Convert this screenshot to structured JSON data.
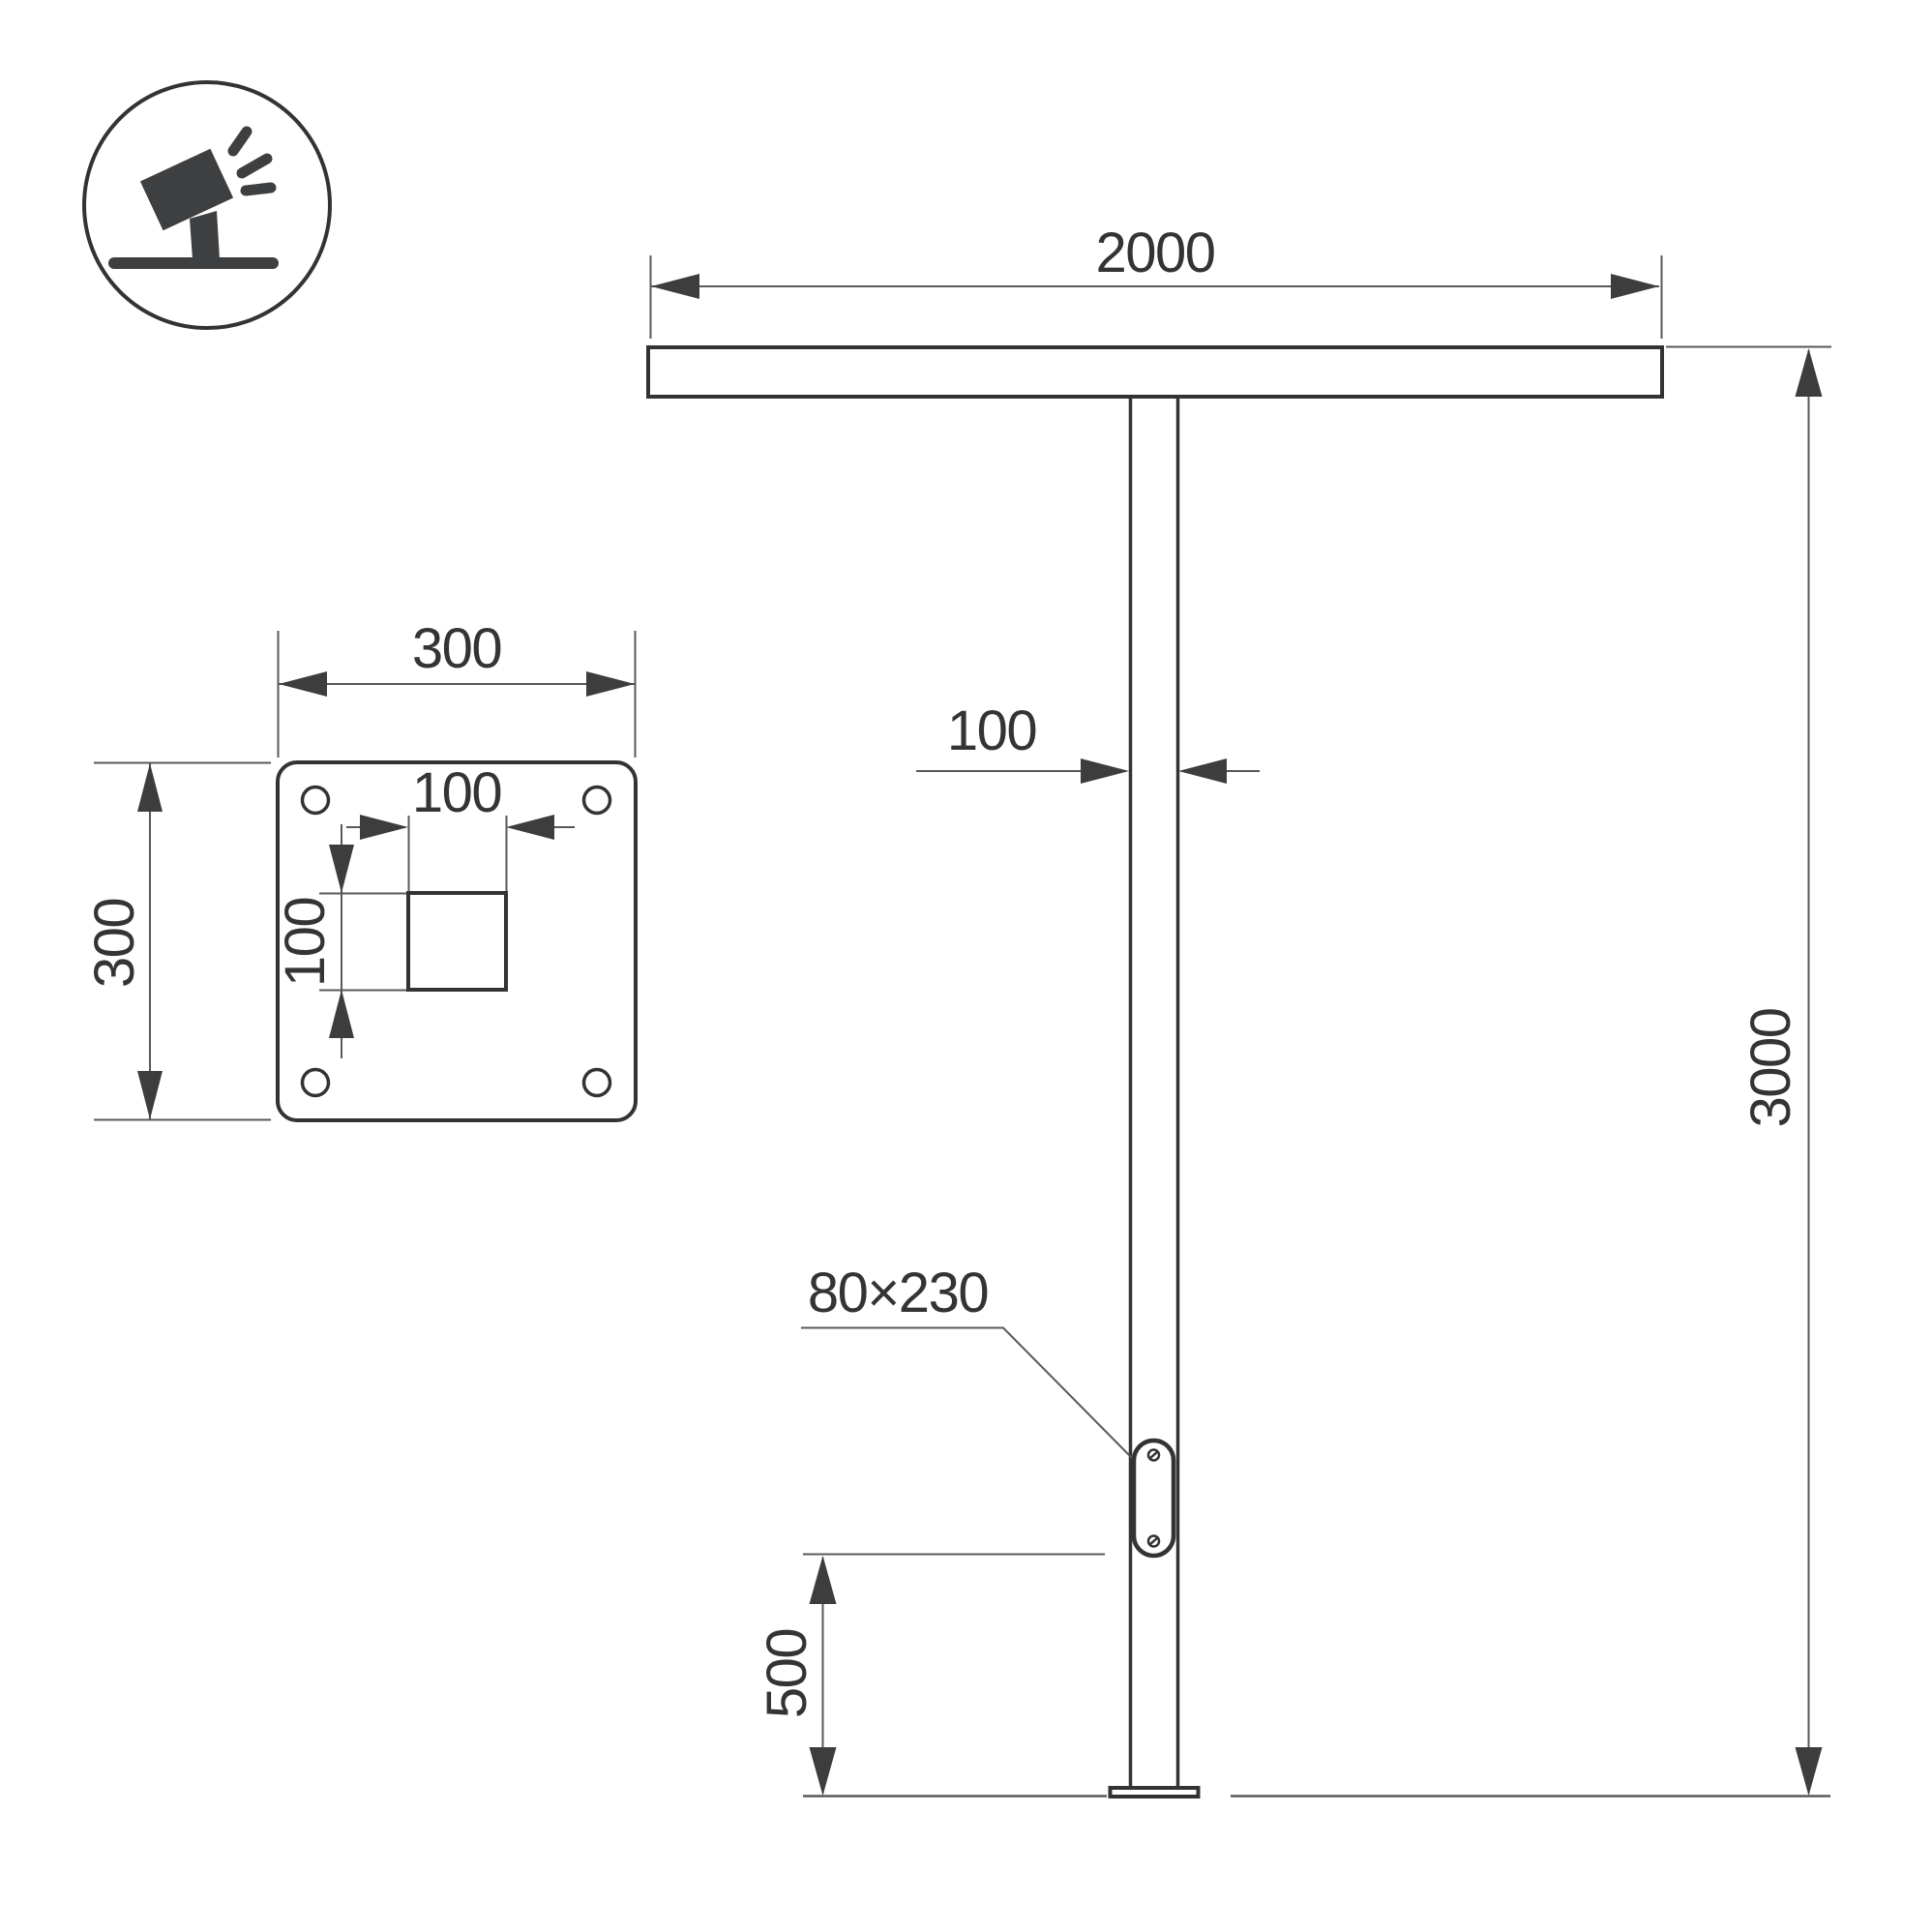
{
  "colors": {
    "outline": "#333333",
    "thin_line": "#595959",
    "arrow_fill": "#3d3d3d",
    "text": "#343434",
    "background": "#ffffff"
  },
  "icon": {
    "name": "tilted-floodlight"
  },
  "elevation": {
    "crossbar_length": "2000",
    "pole_width": "100",
    "total_height": "3000",
    "service_door_size": "80×230",
    "door_bottom_offset": "500"
  },
  "base_plate": {
    "plate_width": "300",
    "plate_height": "300",
    "center_hole_width": "100",
    "center_hole_height": "100"
  }
}
